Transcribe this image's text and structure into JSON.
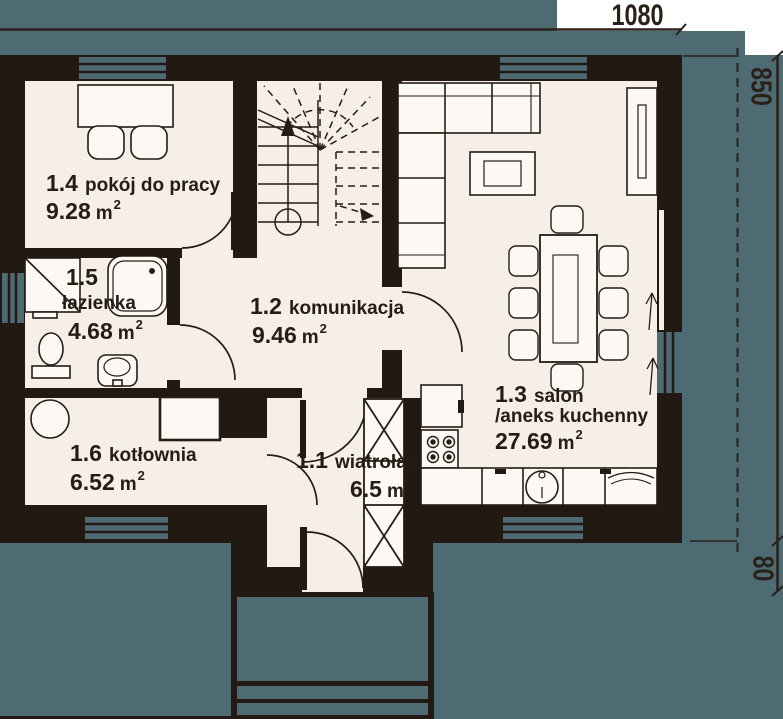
{
  "title": "rzut parteru",
  "dimensions": {
    "top_width": "1080",
    "right_height": "850",
    "right_entry": "80"
  },
  "rooms": [
    {
      "id": "1.4",
      "name": "pokój do pracy",
      "area": "9.28",
      "unit": "m",
      "sup": "2"
    },
    {
      "id": "1.5",
      "name": "łazienka",
      "area": "4.68",
      "unit": "m",
      "sup": "2"
    },
    {
      "id": "1.2",
      "name": "komunikacja",
      "area": "9.46",
      "unit": "m",
      "sup": "2"
    },
    {
      "id": "1.6",
      "name": "kotłownia",
      "area": "6.52",
      "unit": "m",
      "sup": "2"
    },
    {
      "id": "1.1",
      "name": "wiatrołap",
      "area": "6.5",
      "unit": "m",
      "sup": "2"
    },
    {
      "id": "1.3",
      "name": "salon",
      "name2": "/aneks kuchenny",
      "area": "27.69",
      "unit": "m",
      "sup": "2"
    }
  ],
  "colors": {
    "wall": "#221a12",
    "floor": "#f6efe8",
    "glazing_teal": "#4e6b74",
    "line": "#241c15",
    "furniture_fill": "#fcf8f4"
  }
}
